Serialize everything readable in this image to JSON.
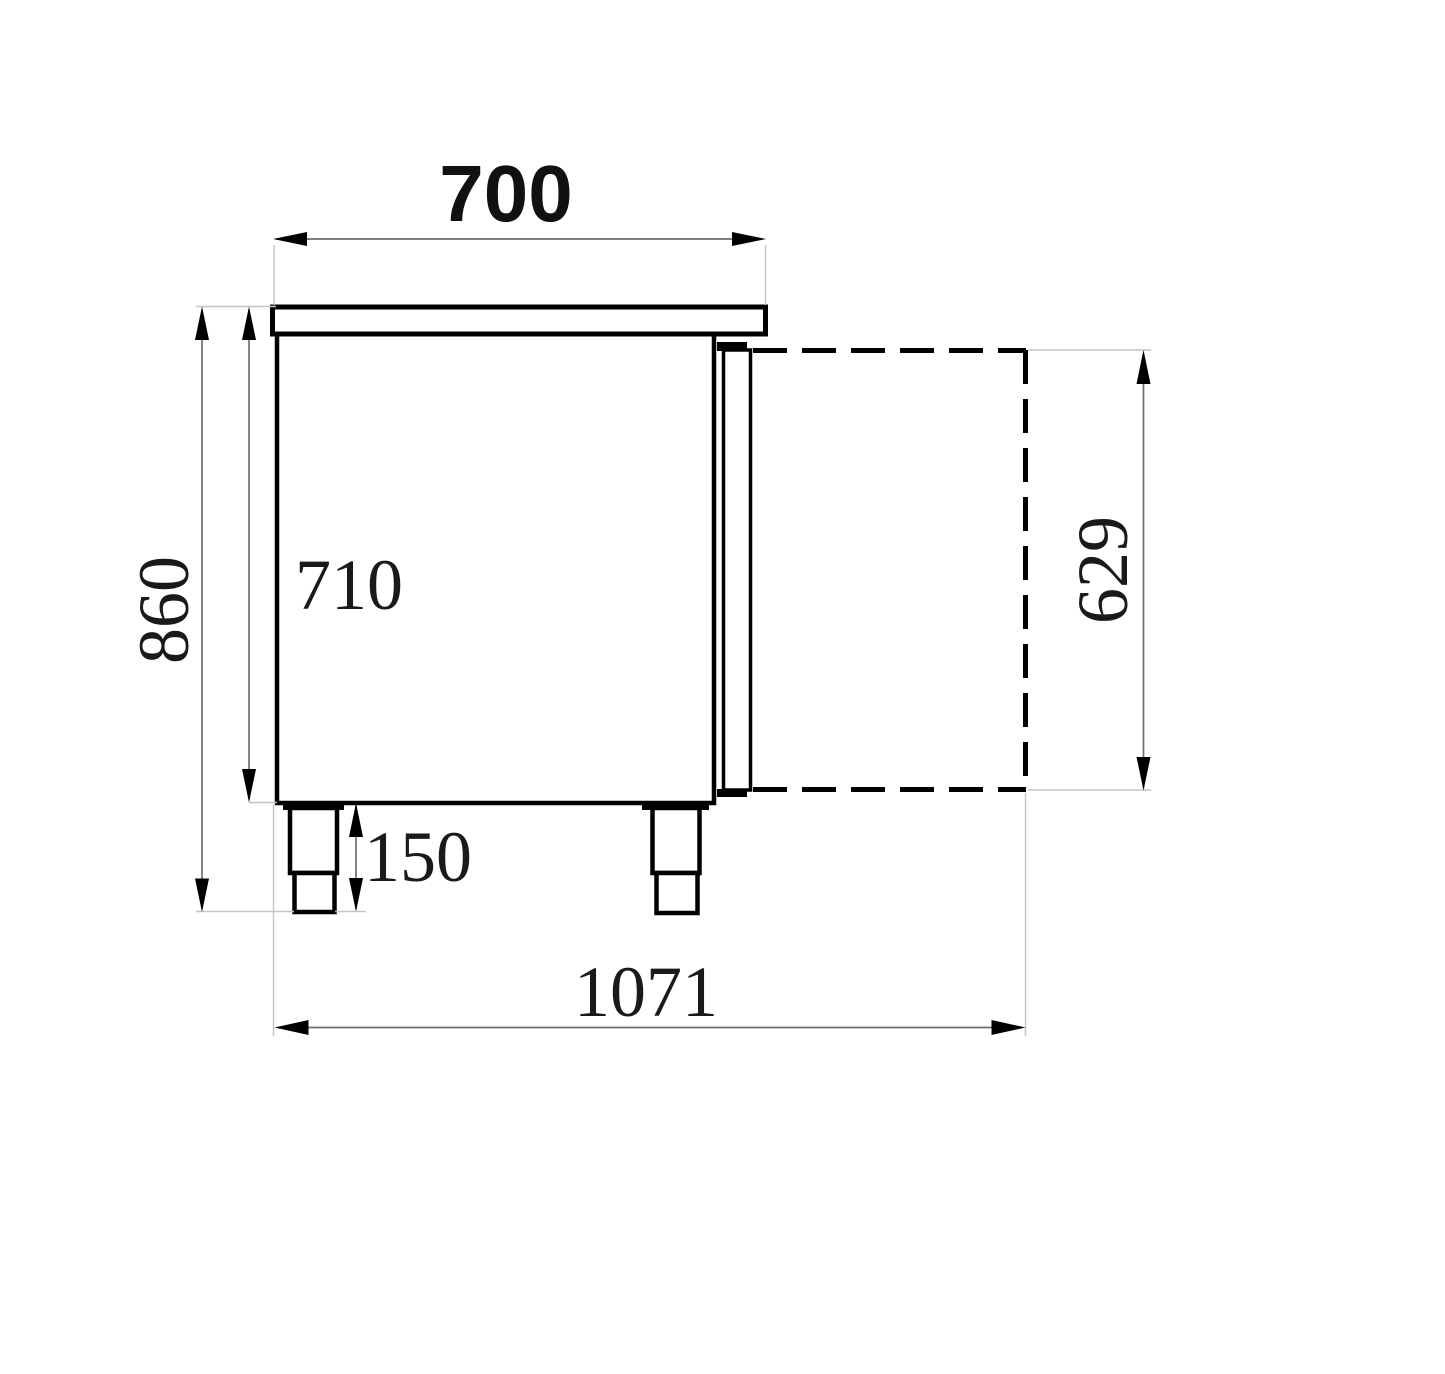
{
  "drawing": {
    "description": "side-view dimension drawing of refrigerated counter with open door",
    "labels": {
      "top_width": "700",
      "overall_height": "860",
      "body_height": "710",
      "leg_height": "150",
      "overall_depth": "1071",
      "door_height": "629"
    },
    "colors": {
      "outline": "#000000",
      "dimension_line": "#6e6e6e",
      "extension_line": "#c4c4c4",
      "background": "#ffffff"
    }
  }
}
